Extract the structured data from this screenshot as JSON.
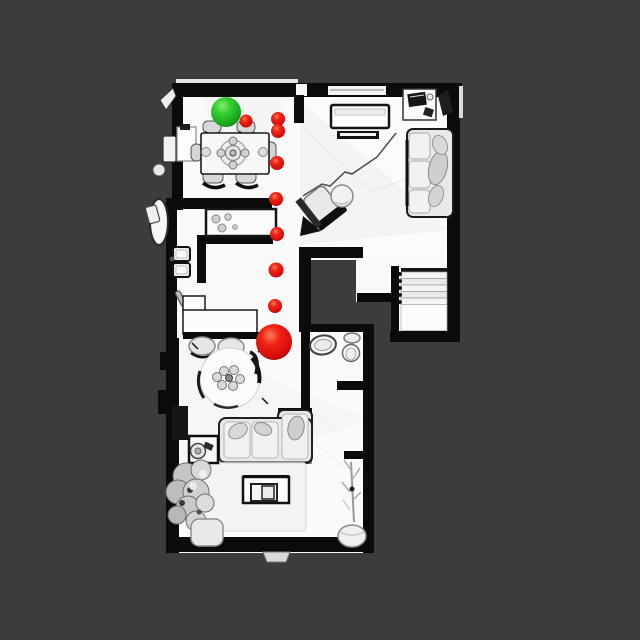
{
  "scene": {
    "type": "indoor-floorplan-3d-scan-topdown",
    "palette": {
      "background": "#3C3C3C",
      "floor": "#FAFAFA",
      "wall": "#0B0B0B",
      "furniture_light": "#E8E8E8",
      "furniture_mid": "#CFCFCF"
    }
  },
  "markers": {
    "start": {
      "label": "start",
      "x": 226,
      "y": 112,
      "r": 15,
      "color": "#2FCB2F"
    },
    "goal": {
      "label": "goal",
      "x": 274,
      "y": 342,
      "r": 18,
      "color": "#E01010"
    },
    "waypoint_color": "#E01010",
    "waypoints": [
      {
        "x": 246,
        "y": 121,
        "r": 6.5
      },
      {
        "x": 278,
        "y": 119,
        "r": 7
      },
      {
        "x": 278,
        "y": 131,
        "r": 7
      },
      {
        "x": 277,
        "y": 163,
        "r": 7
      },
      {
        "x": 276,
        "y": 199,
        "r": 7
      },
      {
        "x": 277,
        "y": 234,
        "r": 7
      },
      {
        "x": 276,
        "y": 270,
        "r": 7.5
      },
      {
        "x": 275,
        "y": 306,
        "r": 7
      }
    ]
  }
}
